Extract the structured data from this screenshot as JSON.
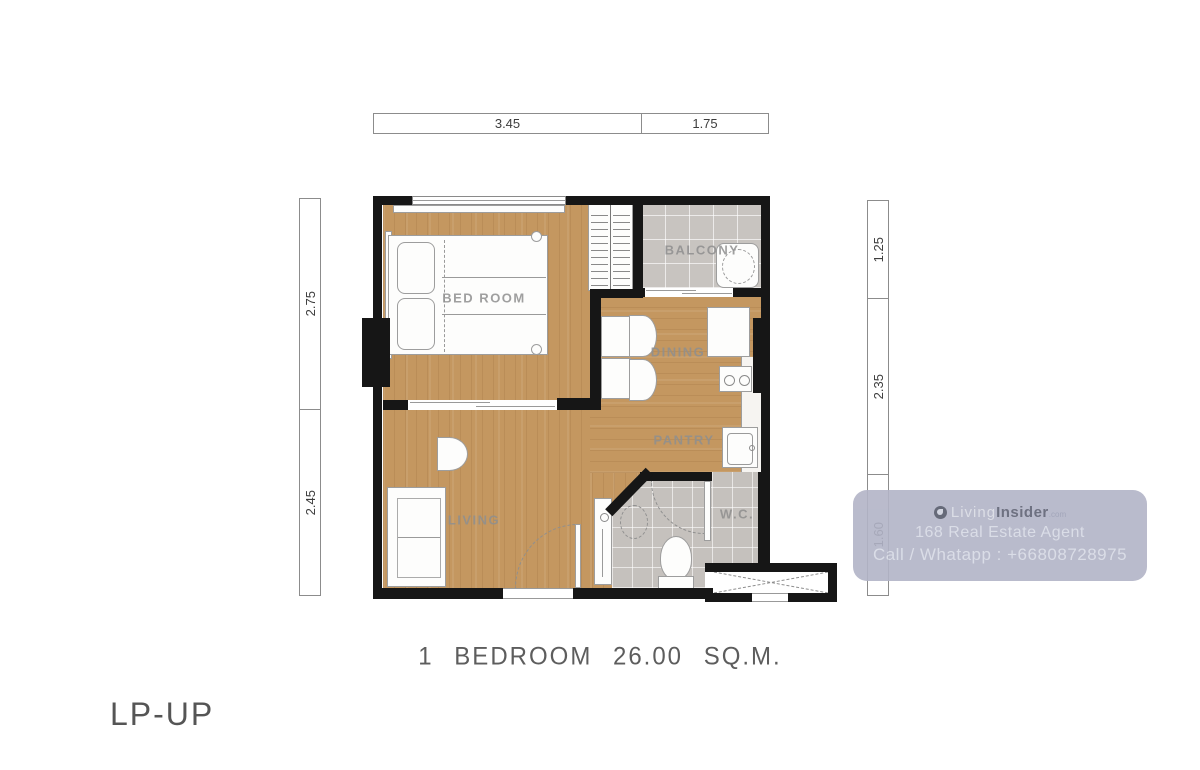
{
  "page": {
    "caption": "1 BEDROOM 26.00 SQ.M.",
    "plan_code": "LP-UP"
  },
  "rooms": {
    "bedroom": "BED ROOM",
    "balcony": "BALCONY",
    "dining": "DINING",
    "pantry": "PANTRY",
    "living": "LIVING",
    "wc": "W.C."
  },
  "dimensions": {
    "top": [
      "3.45",
      "1.75"
    ],
    "left": [
      "2.75",
      "2.45"
    ],
    "right": [
      "1.25",
      "2.35",
      "1.60"
    ]
  },
  "watermark": {
    "brand_light": "Living",
    "brand_bold": "Insider",
    "brand_tld": ".com",
    "agent_line": "168 Real Estate Agent",
    "contact_line": "Call / Whatapp : +66808728975"
  },
  "colors": {
    "wood": "#c49760",
    "tile": "#c8c4c0",
    "bathtile": "#c5c1bd",
    "wall": "#161616",
    "wm": "#b2b4c7"
  }
}
